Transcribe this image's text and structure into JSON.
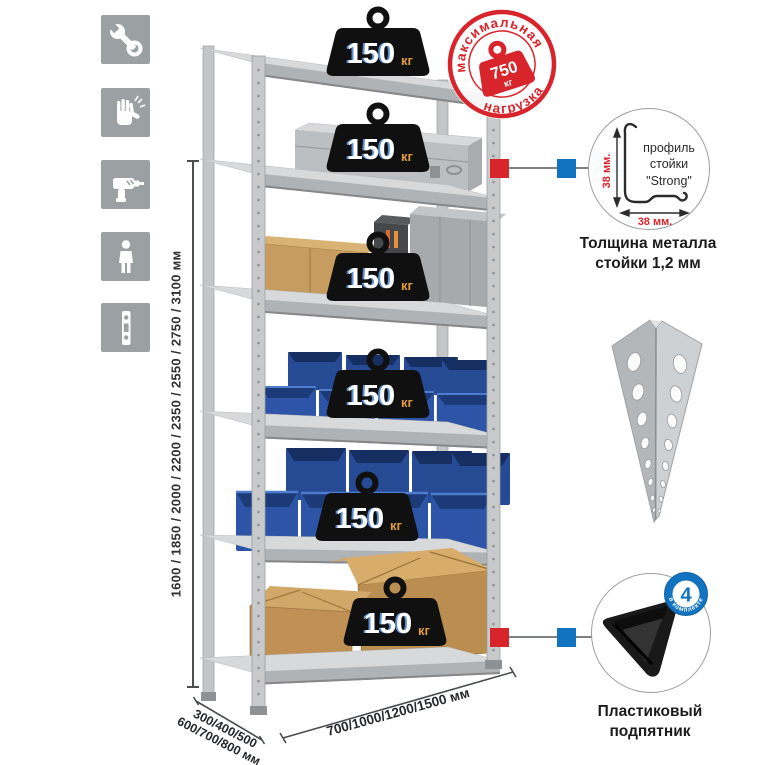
{
  "stamp": {
    "arc_top": "максимальная",
    "arc_bottom": "нагрузка",
    "weight_value": "750",
    "weight_unit": "кг"
  },
  "shelf_weight": {
    "value": "150",
    "unit": "кг",
    "count": 6
  },
  "height_dimension": {
    "label": "1600 / 1850 / 2000 / 2200 / 2350 / 2550 / 2750 / 3100 мм"
  },
  "depth_dimension": {
    "line1": "300/400/500",
    "line2": "600/700/800 мм"
  },
  "width_dimension": {
    "label": "700/1000/1200/1500 мм"
  },
  "profile_detail": {
    "text_line1": "профиль",
    "text_line2": "стойки",
    "text_line3": "\"Strong\"",
    "dim_vertical": "38 мм.",
    "dim_horizontal": "38 мм.",
    "caption_line1": "Толщина металла",
    "caption_line2": "стойки 1,2 мм"
  },
  "foot_detail": {
    "badge_value": "4",
    "badge_arc_text": "в комплекте",
    "caption_line1": "Пластиковый",
    "caption_line2": "подпятник"
  },
  "left_icons": [
    {
      "name": "wrench-icon"
    },
    {
      "name": "gloves-icon"
    },
    {
      "name": "drill-icon"
    },
    {
      "name": "person-icon"
    },
    {
      "name": "perforated-post-icon"
    }
  ],
  "colors": {
    "accent_red": "#d8252c",
    "accent_blue": "#1273c0",
    "tile_gray": "#9ba0a3",
    "weight_black": "#101010",
    "kg_orange": "#e09a3e",
    "bin_blue": "#2d54a6",
    "metal_light": "#d7d9da",
    "metal_mid": "#b0b3b5",
    "cardboard": "#c69c60"
  }
}
